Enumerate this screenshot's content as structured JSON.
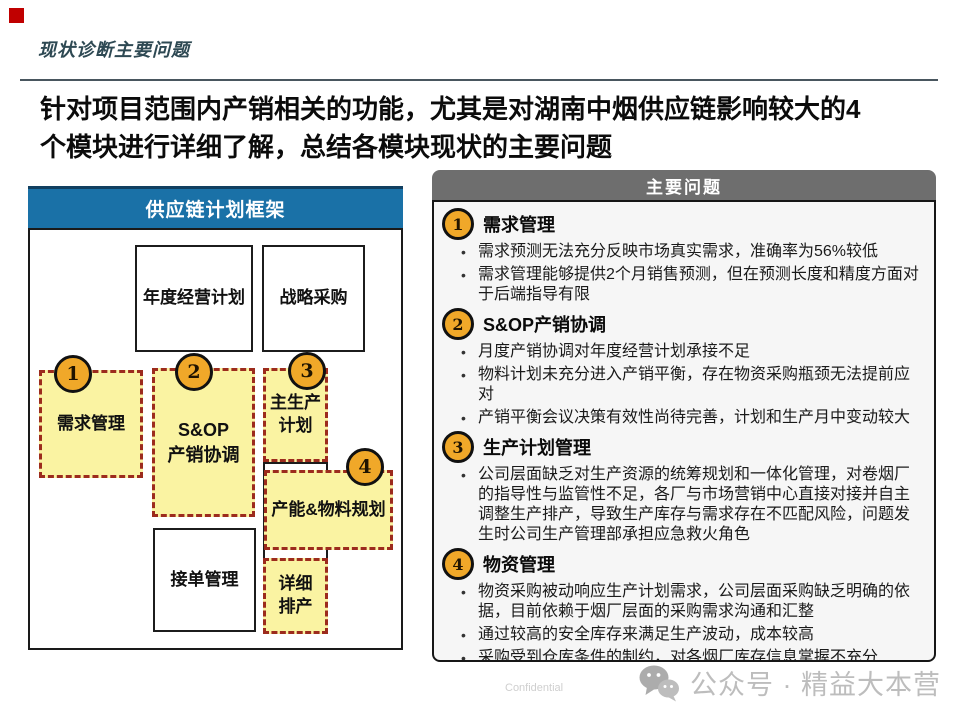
{
  "page": {
    "slide_title": "现状诊断主要问题",
    "heading_line1": "针对项目范围内产销相关的功能，尤其是对湖南中烟供应链影响较大的4",
    "heading_line2": "个模块进行详细了解，总结各模块现状的主要问题",
    "footer": {
      "confidential": "Confidential",
      "watermark": "公众号 · 精益大本营",
      "watermark_icon": "wechat-icon"
    }
  },
  "framework": {
    "title": "供应链计划框架",
    "boxes": {
      "annual_plan": "年度经营计划",
      "strategic_sourcing": "战略采购",
      "demand_mgmt": "需求管理",
      "sop_line1": "S&OP",
      "sop_line2": "产销协调",
      "mps_line1": "主生产",
      "mps_line2": "计划",
      "capacity_material": "产能&物料规划",
      "order_mgmt": "接单管理",
      "detail_line1": "详细",
      "detail_line2": "排产"
    },
    "badges": [
      "1",
      "2",
      "3",
      "4"
    ]
  },
  "issues": {
    "title": "主要问题",
    "sections": [
      {
        "num": "1",
        "heading": "需求管理",
        "bullets": [
          "需求预测无法充分反映市场真实需求，准确率为56%较低",
          "需求管理能够提供2个月销售预测，但在预测长度和精度方面对于后端指导有限"
        ]
      },
      {
        "num": "2",
        "heading": "S&OP产销协调",
        "bullets": [
          "月度产销协调对年度经营计划承接不足",
          "物料计划未充分进入产销平衡，存在物资采购瓶颈无法提前应对",
          "产销平衡会议决策有效性尚待完善，计划和生产月中变动较大"
        ]
      },
      {
        "num": "3",
        "heading": "生产计划管理",
        "bullets": [
          "公司层面缺乏对生产资源的统筹规划和一体化管理，对卷烟厂的指导性与监管性不足，各厂与市场营销中心直接对接并自主调整生产排产，导致生产库存与需求存在不匹配风险，问题发生时公司生产管理部承担应急救火角色"
        ]
      },
      {
        "num": "4",
        "heading": "物资管理",
        "bullets": [
          "物资采购被动响应生产计划需求，公司层面采购缺乏明确的依据，目前依赖于烟厂层面的采购需求沟通和汇整",
          "通过较高的安全库存来满足生产波动，成本较高",
          "采购受到仓库条件的制约，对各烟厂库存信息掌握不充分"
        ]
      }
    ]
  },
  "colors": {
    "accent_blue": "#1A71A7",
    "header_gray": "#6E6E6E",
    "highlight_yellow": "#FAF3A2",
    "dashed_red": "#9C2B1D",
    "badge_orange": "#F0A829",
    "logo_red": "#C00000"
  }
}
